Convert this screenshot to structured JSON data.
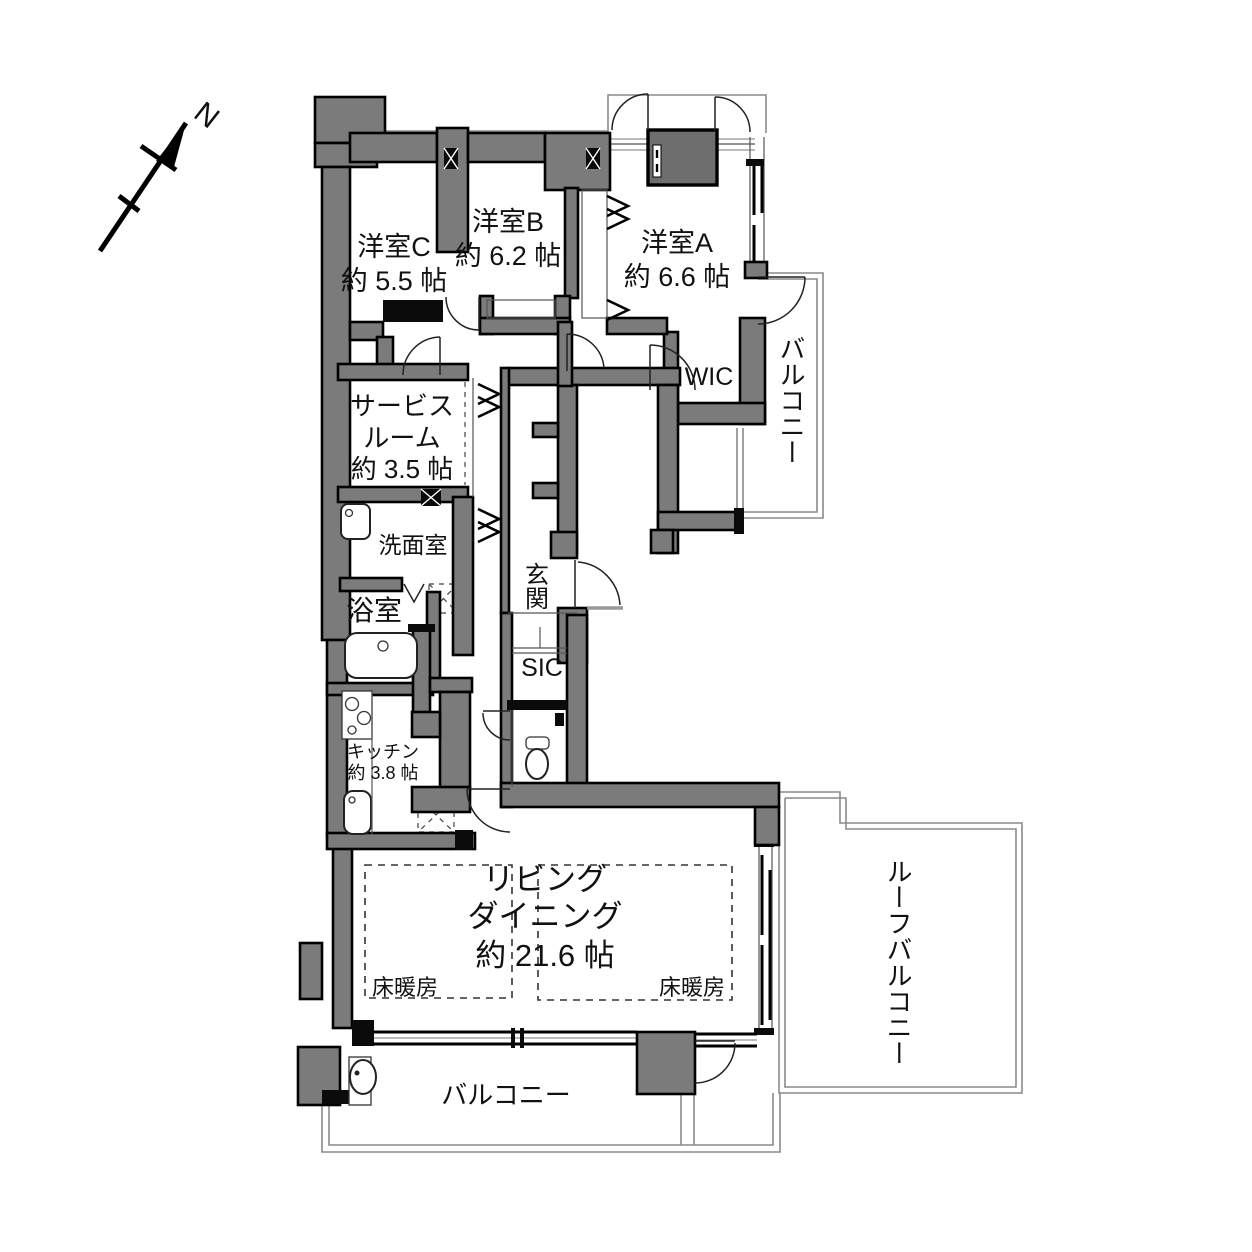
{
  "compass": {
    "north_label": "N"
  },
  "rooms": {
    "yoshitsu_c": {
      "name": "洋室C",
      "size": "約 5.5 帖"
    },
    "yoshitsu_b": {
      "name": "洋室B",
      "size": "約 6.2 帖"
    },
    "yoshitsu_a": {
      "name": "洋室A",
      "size": "約 6.6 帖"
    },
    "wic": {
      "name": "WIC"
    },
    "service_room": {
      "name_line1": "サービス",
      "name_line2": "ルーム",
      "size": "約 3.5 帖"
    },
    "senmenshitsu": {
      "name": "洗面室"
    },
    "yokushitsu": {
      "name": "浴室"
    },
    "genkan": {
      "name": "玄関"
    },
    "sic": {
      "name": "SIC"
    },
    "kitchen": {
      "name": "キッチン",
      "size": "約 3.8 帖"
    },
    "living_dining": {
      "name_line1": "リビング",
      "name_line2": "ダイニング",
      "size": "約 21.6 帖"
    },
    "floor_heating_left": {
      "name": "床暖房"
    },
    "floor_heating_right": {
      "name": "床暖房"
    },
    "balcony_right": {
      "name": "バルコニー"
    },
    "balcony_bottom": {
      "name": "バルコニー"
    },
    "roof_balcony": {
      "name": "ルーフバルコニー"
    }
  },
  "colors": {
    "wall_gray": "#7b7b7b",
    "line_black": "#000000",
    "outline_gray": "#8a8a8a"
  }
}
